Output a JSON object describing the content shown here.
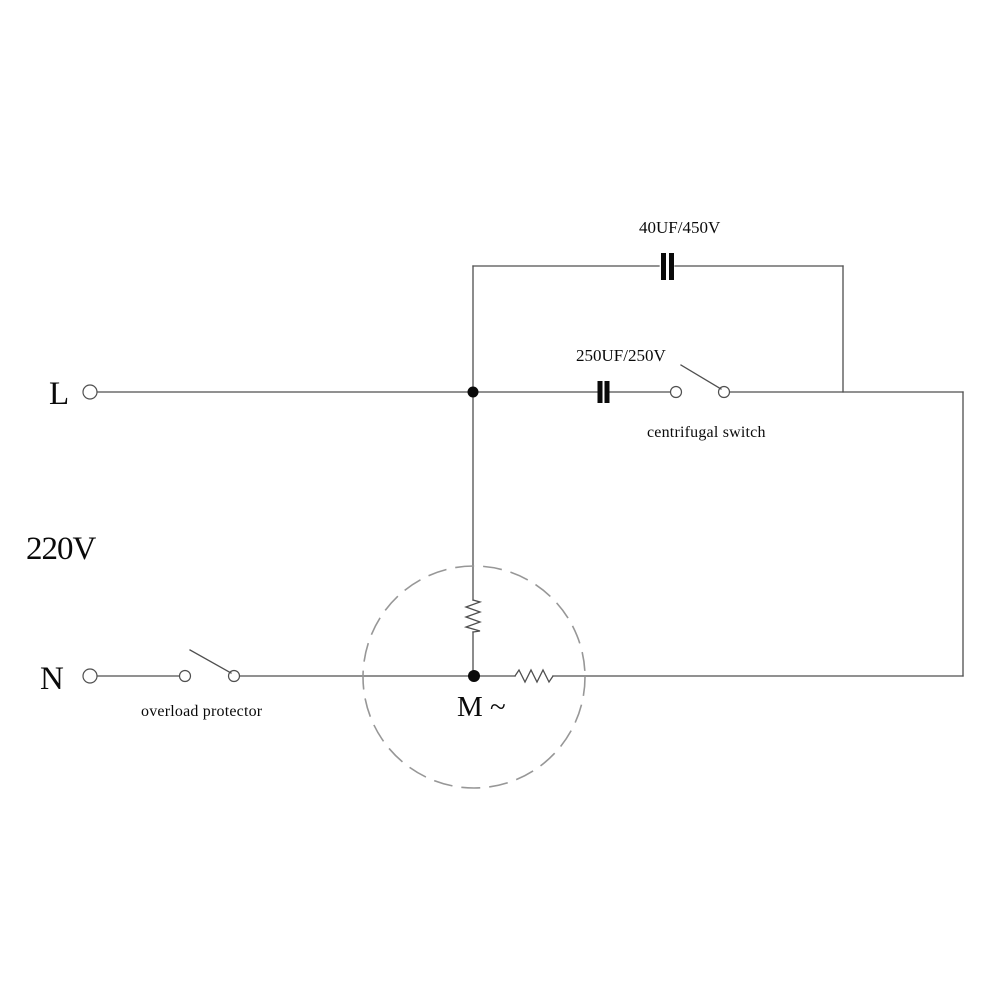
{
  "diagram": {
    "supply": {
      "line_label": "L",
      "neutral_label": "N",
      "voltage_label": "220V"
    },
    "components": {
      "run_capacitor_label": "40UF/450V",
      "start_capacitor_label": "250UF/250V",
      "centrifugal_switch_label": "centrifugal switch",
      "overload_protector_label": "overload protector",
      "motor_label": "M ~"
    },
    "colors": {
      "wire": "#4f4f4f",
      "text": "#0a0a0a",
      "motor_circle": "#979797",
      "background": "#ffffff"
    }
  }
}
